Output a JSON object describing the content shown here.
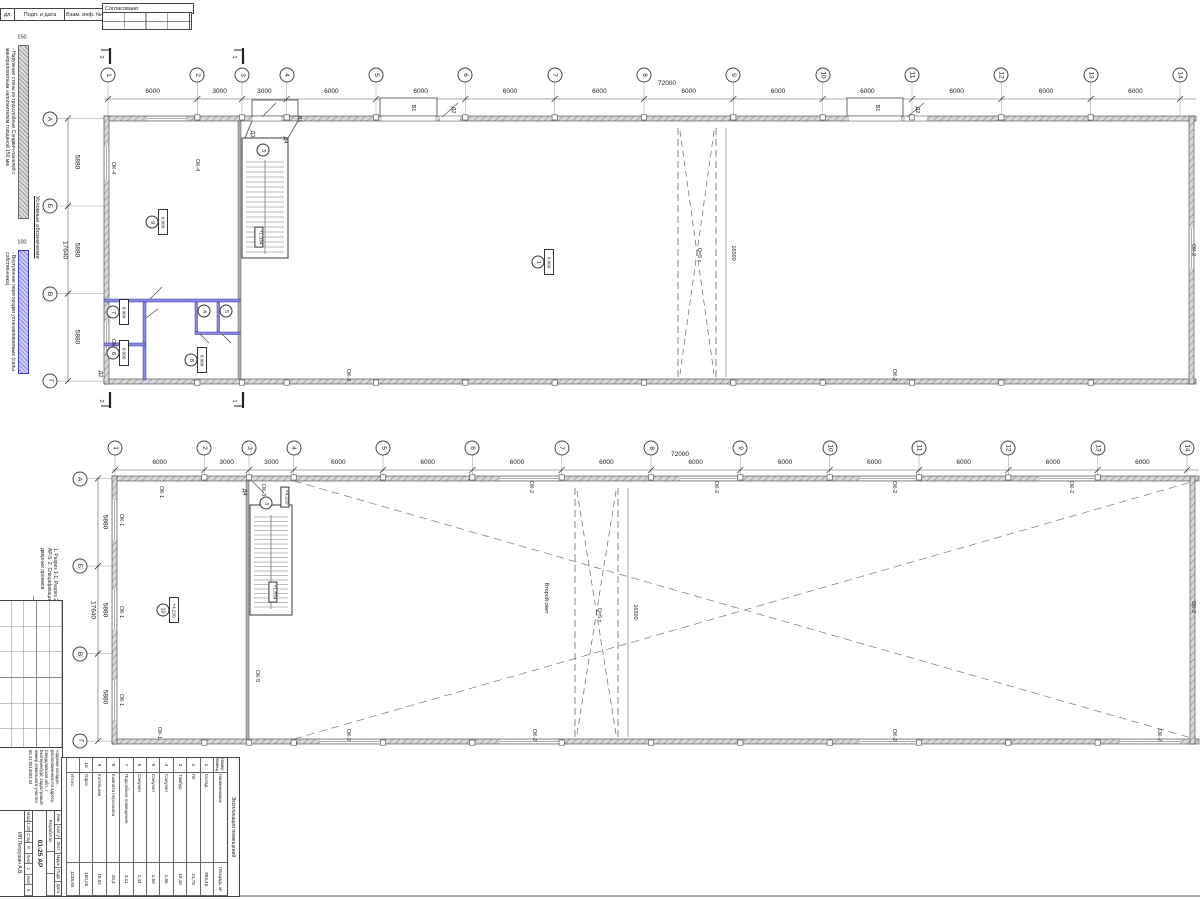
{
  "stamp_top": {
    "col1": "дл.",
    "col2": "Подп. и дата",
    "col3": "Взам. инф. №",
    "approved": "Согласовано"
  },
  "legend": {
    "title": "Условные обозначения",
    "items": [
      {
        "dim": "150",
        "desc": "- Наружные стены из трехслойных Сэндвич-панелей с минераловатным наполнителем толщиной 150 мм"
      },
      {
        "dim": "100",
        "desc": "- Внутренние перегородки устанавливаемые (силы собственника)"
      }
    ]
  },
  "notes": "1. Разрез 1-1, Разрез 2-2 Выполнены см. л. АР-5.  2. Спецификация заполнения оконных и дверных проемов",
  "plan1": {
    "axes": {
      "labels": [
        "1",
        "2",
        "3",
        "4",
        "5",
        "6",
        "7",
        "8",
        "9",
        "10",
        "11",
        "12",
        "13",
        "14"
      ],
      "spacings_mm": [
        6000,
        3000,
        3000,
        6000,
        6000,
        6000,
        6000,
        6000,
        6000,
        6000,
        6000,
        6000,
        6000
      ],
      "total_mm": "72000"
    },
    "rows": {
      "labels": [
        "А",
        "Б",
        "В",
        "Г"
      ],
      "spacings_mm": [
        5880,
        5880,
        5880
      ],
      "total_mm": "17640"
    },
    "annotations": [
      {
        "t": "ОК-4",
        "x": 112,
        "y": 168,
        "r": 90
      },
      {
        "t": "ОК-4",
        "x": 196,
        "y": 165,
        "r": 90
      },
      {
        "t": "ОК-6",
        "x": 112,
        "y": 345,
        "r": 90
      },
      {
        "t": "Д2",
        "x": 99,
        "y": 374,
        "r": 90
      },
      {
        "t": "Д1",
        "x": 298,
        "y": 119,
        "r": 90
      },
      {
        "t": "Д3",
        "x": 251,
        "y": 134,
        "r": 90
      },
      {
        "t": "Д4",
        "x": 284,
        "y": 140,
        "r": 90
      },
      {
        "t": "В1",
        "x": 412,
        "y": 108,
        "r": 90
      },
      {
        "t": "Д2",
        "x": 452,
        "y": 110,
        "r": 90
      },
      {
        "t": "В1",
        "x": 876,
        "y": 108,
        "r": 90
      },
      {
        "t": "Д2",
        "x": 916,
        "y": 110,
        "r": 90
      },
      {
        "t": "ОК-2",
        "x": 347,
        "y": 375,
        "r": 90
      },
      {
        "t": "ОК-2",
        "x": 893,
        "y": 375,
        "r": 90
      },
      {
        "t": "ОК-2",
        "x": 1192,
        "y": 250,
        "r": 90
      },
      {
        "t": "Q=5 т",
        "x": 698,
        "y": 255,
        "r": 90
      },
      {
        "t": "16500",
        "x": 732,
        "y": 253,
        "r": 90
      },
      {
        "t": "+1.034",
        "x": 259,
        "y": 237,
        "r": 90,
        "box": true
      },
      {
        "t": "2",
        "x": 100,
        "y": 57,
        "r": 90
      },
      {
        "t": "1",
        "x": 233,
        "y": 57,
        "r": 90
      },
      {
        "t": "2",
        "x": 100,
        "y": 401,
        "r": 90
      },
      {
        "t": "1",
        "x": 233,
        "y": 401,
        "r": 90
      }
    ],
    "room_markers": [
      {
        "num": "9",
        "elev": "0.000",
        "x": 152,
        "y": 222
      },
      {
        "num": "3",
        "x": 263,
        "y": 150
      },
      {
        "num": "1",
        "elev": "0.000",
        "x": 538,
        "y": 262
      },
      {
        "num": "7",
        "elev": "0.000",
        "x": 113,
        "y": 312
      },
      {
        "num": "4",
        "x": 204,
        "y": 311
      },
      {
        "num": "5",
        "x": 226,
        "y": 311
      },
      {
        "num": "6",
        "elev": "0.000",
        "x": 113,
        "y": 353
      },
      {
        "num": "8",
        "elev": "0.000",
        "x": 191,
        "y": 360
      }
    ]
  },
  "plan2": {
    "axes": {
      "labels": [
        "1",
        "2",
        "3",
        "4",
        "5",
        "6",
        "7",
        "8",
        "9",
        "10",
        "11",
        "12",
        "13",
        "14"
      ],
      "spacings_mm": [
        6000,
        3000,
        3000,
        6000,
        6000,
        6000,
        6000,
        6000,
        6000,
        6000,
        6000,
        6000,
        6000
      ],
      "total_mm": "72000"
    },
    "rows": {
      "labels": [
        "А",
        "Б",
        "В",
        "Г"
      ],
      "spacings_mm": [
        5880,
        5880,
        5880
      ],
      "total_mm": "17640"
    },
    "second_light": "Второй свет",
    "annotations": [
      {
        "t": "ОК-1",
        "x": 120,
        "y": 520,
        "r": 90
      },
      {
        "t": "ОК-1",
        "x": 120,
        "y": 612,
        "r": 90
      },
      {
        "t": "ОК-1",
        "x": 120,
        "y": 700,
        "r": 90
      },
      {
        "t": "ОК-1",
        "x": 158,
        "y": 733,
        "r": 90
      },
      {
        "t": "ОК-1",
        "x": 160,
        "y": 492,
        "r": 90
      },
      {
        "t": "ОК-3",
        "x": 262,
        "y": 490,
        "r": 90
      },
      {
        "t": "ОК-5",
        "x": 256,
        "y": 676,
        "r": 90
      },
      {
        "t": "Д4",
        "x": 243,
        "y": 492,
        "r": 90
      },
      {
        "t": "ОК-2",
        "x": 530,
        "y": 487,
        "r": 90
      },
      {
        "t": "ОК-2",
        "x": 715,
        "y": 487,
        "r": 90
      },
      {
        "t": "ОК-2",
        "x": 893,
        "y": 487,
        "r": 90
      },
      {
        "t": "ОК-2",
        "x": 1070,
        "y": 487,
        "r": 90
      },
      {
        "t": "ОК-2",
        "x": 347,
        "y": 735,
        "r": 90
      },
      {
        "t": "ОК-2",
        "x": 533,
        "y": 735,
        "r": 90
      },
      {
        "t": "ОК-2",
        "x": 893,
        "y": 735,
        "r": 90
      },
      {
        "t": "ОК-2",
        "x": 1158,
        "y": 735,
        "r": 90
      },
      {
        "t": "ОК-2",
        "x": 1192,
        "y": 607,
        "r": 90
      },
      {
        "t": "Q=5 т",
        "x": 598,
        "y": 615,
        "r": 90
      },
      {
        "t": "16500",
        "x": 634,
        "y": 612,
        "r": 90
      },
      {
        "t": "Второй свет",
        "x": 545,
        "y": 598,
        "r": 90
      },
      {
        "t": "+4.220",
        "x": 285,
        "y": 497,
        "r": 90,
        "box": true
      },
      {
        "t": "+1.834",
        "x": 273,
        "y": 592,
        "r": 90,
        "box": true
      }
    ],
    "room_markers": [
      {
        "num": "3",
        "x": 266,
        "y": 503
      },
      {
        "num": "10",
        "elev": "+4.220",
        "x": 163,
        "y": 610
      }
    ]
  },
  "schedule": {
    "title": "Экспликация помещений",
    "cols": [
      "Номер помещ.",
      "Наименование",
      "Площадь, м²"
    ],
    "rows": [
      [
        "1",
        "Склад",
        "983,45"
      ],
      [
        "2",
        "ЛК",
        "21,76"
      ],
      [
        "3",
        "Тамбур",
        "18,16"
      ],
      [
        "4",
        "Санузел",
        "1,66"
      ],
      [
        "5",
        "Санузел",
        "1,69"
      ],
      [
        "6",
        "Санузел",
        "1,44"
      ],
      [
        "7",
        "Подсобное помещение",
        "3,11"
      ],
      [
        "8",
        "Комната персонала",
        "28,4"
      ],
      [
        "9",
        "Котельная",
        "18,92"
      ],
      [
        "10",
        "Офис",
        "160,26"
      ]
    ],
    "total_label": "Итого",
    "total_value": "1238,85"
  },
  "titleblock": {
    "header_cells": [
      "Изм",
      "Кол.уч",
      "Лист",
      "№док",
      "Подп",
      "Дата"
    ],
    "role": "Разработал",
    "doc": "01-25 АР",
    "project": "«Здание склада», расположенное по адресу: Свердловская обл., г. Екатеринбург, кадастровый номер земельного участка 66:41:0614003:34",
    "developer": "ИП Петрушин А.В.",
    "scale_label": "Масшт.",
    "scale": "1:200",
    "stage_label": "Стадия",
    "stage": "Р",
    "sheet_label": "Лист",
    "sheet_no": "1",
    "sheets_label": "Листов",
    "sheets": "6"
  }
}
